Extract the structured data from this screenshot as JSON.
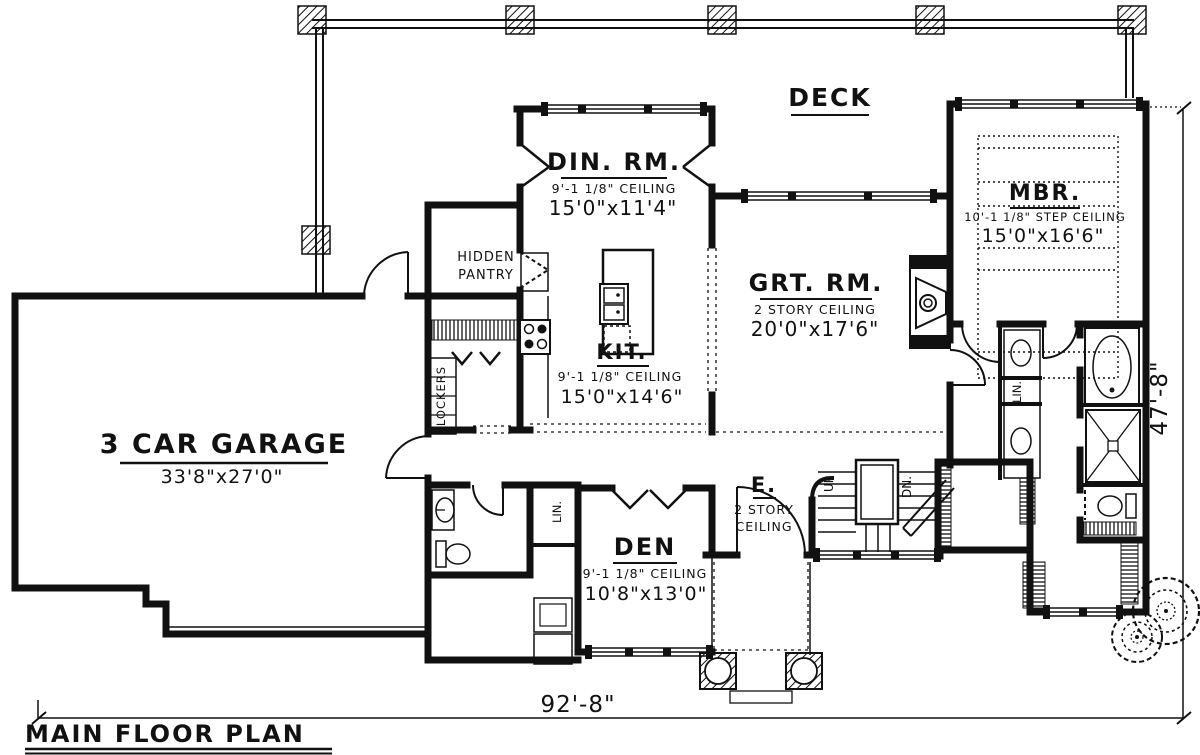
{
  "title": {
    "text": "MAIN FLOOR PLAN"
  },
  "dimensions": {
    "overall_width": "92'-8\"",
    "overall_depth": "47'-8\""
  },
  "rooms": {
    "deck": {
      "name": "DECK"
    },
    "dining": {
      "name": "DIN. RM.",
      "ceiling": "9'-1 1/8\" CEILING",
      "size": "15'0\"x11'4\""
    },
    "great": {
      "name": "GRT. RM.",
      "ceiling": "2 STORY CEILING",
      "size": "20'0\"x17'6\""
    },
    "master": {
      "name": "MBR.",
      "ceiling": "10'-1 1/8\" STEP CEILING",
      "size": "15'0\"x16'6\""
    },
    "kitchen": {
      "name": "KIT.",
      "ceiling": "9'-1 1/8\" CEILING",
      "size": "15'0\"x14'6\""
    },
    "pantry": {
      "name_line1": "HIDDEN",
      "name_line2": "PANTRY"
    },
    "garage": {
      "name": "3 CAR GARAGE",
      "size": "33'8\"x27'0\""
    },
    "den": {
      "name": "DEN",
      "ceiling": "9'-1 1/8\" CEILING",
      "size": "10'8\"x13'0\""
    },
    "entry": {
      "name": "E.",
      "ceiling_line1": "2 STORY",
      "ceiling_line2": "CEILING"
    }
  },
  "labels": {
    "lockers": "LOCKERS",
    "linen_hall": "LIN.",
    "linen_bath": "LIN.",
    "stairs_up": "UP",
    "stairs_down": "DN."
  },
  "colors": {
    "ink": "#111111",
    "paper": "#ffffff"
  }
}
